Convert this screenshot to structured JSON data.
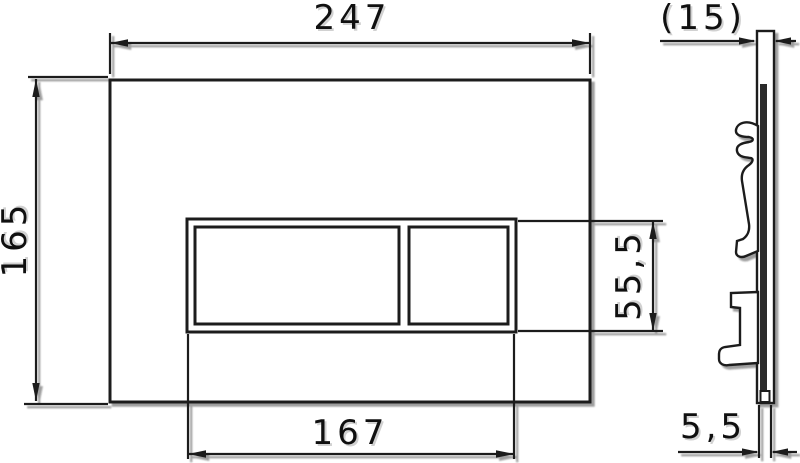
{
  "drawing": {
    "front_view": {
      "plate_width_label": "247",
      "plate_height_label": "165",
      "button_area_width_label": "167",
      "button_area_height_label": "55,5"
    },
    "side_view": {
      "depth_label": "(15)",
      "protrusion_label": "5,5"
    },
    "colors": {
      "line": "#1f1f1f",
      "background": "#ffffff",
      "shadow": "#1a1a1a"
    }
  }
}
